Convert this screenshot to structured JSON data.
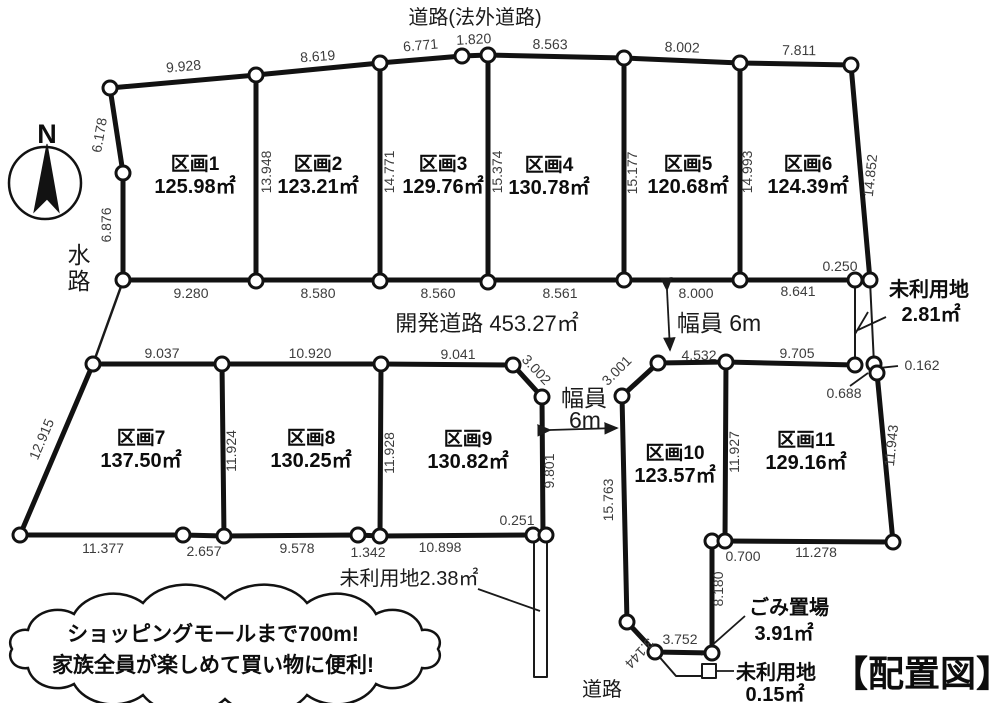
{
  "header": {
    "top_road": "道路(法外道路)",
    "compass_n": "N",
    "waterway_char1": "水",
    "waterway_char2": "路",
    "bottom_road": "道路",
    "title": "【配置図】"
  },
  "roads": {
    "dev_road": "開発道路 453.27㎡",
    "width_right": "幅員 6m",
    "width_mid_line1": "幅員",
    "width_mid_line2": "6m"
  },
  "plots": [
    {
      "name": "区画1",
      "area": "125.98㎡",
      "x": 195,
      "y": 170
    },
    {
      "name": "区画2",
      "area": "123.21㎡",
      "x": 318,
      "y": 170
    },
    {
      "name": "区画3",
      "area": "129.76㎡",
      "x": 443,
      "y": 170
    },
    {
      "name": "区画4",
      "area": "130.78㎡",
      "x": 549,
      "y": 171
    },
    {
      "name": "区画5",
      "area": "120.68㎡",
      "x": 688,
      "y": 170
    },
    {
      "name": "区画6",
      "area": "124.39㎡",
      "x": 808,
      "y": 170
    },
    {
      "name": "区画7",
      "area": "137.50㎡",
      "x": 141,
      "y": 444
    },
    {
      "name": "区画8",
      "area": "130.25㎡",
      "x": 311,
      "y": 444
    },
    {
      "name": "区画9",
      "area": "130.82㎡",
      "x": 468,
      "y": 445
    },
    {
      "name": "区画10",
      "area": "123.57㎡",
      "x": 675,
      "y": 459
    },
    {
      "name": "区画11",
      "area": "129.16㎡",
      "x": 806,
      "y": 446
    }
  ],
  "annotations": {
    "unused_right_line1": "未利用地",
    "unused_right_line2": "2.81㎡",
    "unused_strip": "未利用地2.38㎡",
    "garbage_line1": "ごみ置場",
    "garbage_line2": "3.91㎡",
    "unused_small_line1": "未利用地",
    "unused_small_line2": "0.15㎡",
    "callout_line1": "ショッピングモールまで700m!",
    "callout_line2": "家族全員が楽しめて買い物に便利!"
  },
  "dimensions": [
    {
      "v": "9.928",
      "x": 184,
      "y": 71,
      "r": -5
    },
    {
      "v": "8.619",
      "x": 318,
      "y": 61,
      "r": -4
    },
    {
      "v": "6.771",
      "x": 421,
      "y": 50,
      "r": -5
    },
    {
      "v": "1.820",
      "x": 474,
      "y": 44,
      "r": -3
    },
    {
      "v": "8.563",
      "x": 550,
      "y": 49,
      "r": 1
    },
    {
      "v": "8.002",
      "x": 682,
      "y": 52,
      "r": 2
    },
    {
      "v": "7.811",
      "x": 799,
      "y": 55,
      "r": 1
    },
    {
      "v": "6.178",
      "x": 104,
      "y": 136,
      "r": -80
    },
    {
      "v": "6.876",
      "x": 111,
      "y": 225,
      "r": -90
    },
    {
      "v": "13.948",
      "x": 271,
      "y": 172,
      "r": -90
    },
    {
      "v": "14.771",
      "x": 394,
      "y": 172,
      "r": -90
    },
    {
      "v": "15.374",
      "x": 502,
      "y": 172,
      "r": -90
    },
    {
      "v": "15.177",
      "x": 637,
      "y": 173,
      "r": -90
    },
    {
      "v": "14.993",
      "x": 752,
      "y": 172,
      "r": -90
    },
    {
      "v": "14.852",
      "x": 875,
      "y": 176,
      "r": -84
    },
    {
      "v": "0.250",
      "x": 840,
      "y": 271,
      "r": 0
    },
    {
      "v": "9.280",
      "x": 191,
      "y": 298,
      "r": 0
    },
    {
      "v": "8.580",
      "x": 318,
      "y": 298,
      "r": 0
    },
    {
      "v": "8.560",
      "x": 438,
      "y": 298,
      "r": 0
    },
    {
      "v": "8.561",
      "x": 560,
      "y": 298,
      "r": 0
    },
    {
      "v": "8.000",
      "x": 696,
      "y": 298,
      "r": 0
    },
    {
      "v": "8.641",
      "x": 798,
      "y": 296,
      "r": 0
    },
    {
      "v": "9.037",
      "x": 162,
      "y": 358,
      "r": 0
    },
    {
      "v": "10.920",
      "x": 310,
      "y": 358,
      "r": 0
    },
    {
      "v": "9.041",
      "x": 458,
      "y": 359,
      "r": 0
    },
    {
      "v": "3.002",
      "x": 533,
      "y": 373,
      "r": 47
    },
    {
      "v": "3.001",
      "x": 620,
      "y": 374,
      "r": -45
    },
    {
      "v": "4.532",
      "x": 699,
      "y": 360,
      "r": 0
    },
    {
      "v": "9.705",
      "x": 797,
      "y": 358,
      "r": 0
    },
    {
      "v": "0.162",
      "x": 922,
      "y": 370,
      "r": 0
    },
    {
      "v": "0.688",
      "x": 844,
      "y": 398,
      "r": 0
    },
    {
      "v": "12.915",
      "x": 46,
      "y": 441,
      "r": -67
    },
    {
      "v": "11.924",
      "x": 236,
      "y": 451,
      "r": -90
    },
    {
      "v": "11.928",
      "x": 394,
      "y": 453,
      "r": -90
    },
    {
      "v": "9.801",
      "x": 554,
      "y": 471,
      "r": -90
    },
    {
      "v": "15.763",
      "x": 613,
      "y": 500,
      "r": -90
    },
    {
      "v": "11.927",
      "x": 739,
      "y": 452,
      "r": -90
    },
    {
      "v": "11.943",
      "x": 896,
      "y": 446,
      "r": -84
    },
    {
      "v": "8.180",
      "x": 723,
      "y": 589,
      "r": -90
    },
    {
      "v": "3.144",
      "x": 636,
      "y": 650,
      "r": 133
    },
    {
      "v": "11.377",
      "x": 103,
      "y": 553,
      "r": 0
    },
    {
      "v": "2.657",
      "x": 204,
      "y": 556,
      "r": 0
    },
    {
      "v": "9.578",
      "x": 297,
      "y": 553,
      "r": 0
    },
    {
      "v": "1.342",
      "x": 368,
      "y": 557,
      "r": 0
    },
    {
      "v": "10.898",
      "x": 440,
      "y": 552,
      "r": 0
    },
    {
      "v": "0.251",
      "x": 517,
      "y": 525,
      "r": 0
    },
    {
      "v": "0.700",
      "x": 743,
      "y": 561,
      "r": 0
    },
    {
      "v": "11.278",
      "x": 816,
      "y": 557,
      "r": 0
    },
    {
      "v": "3.752",
      "x": 680,
      "y": 644,
      "r": 0
    }
  ]
}
